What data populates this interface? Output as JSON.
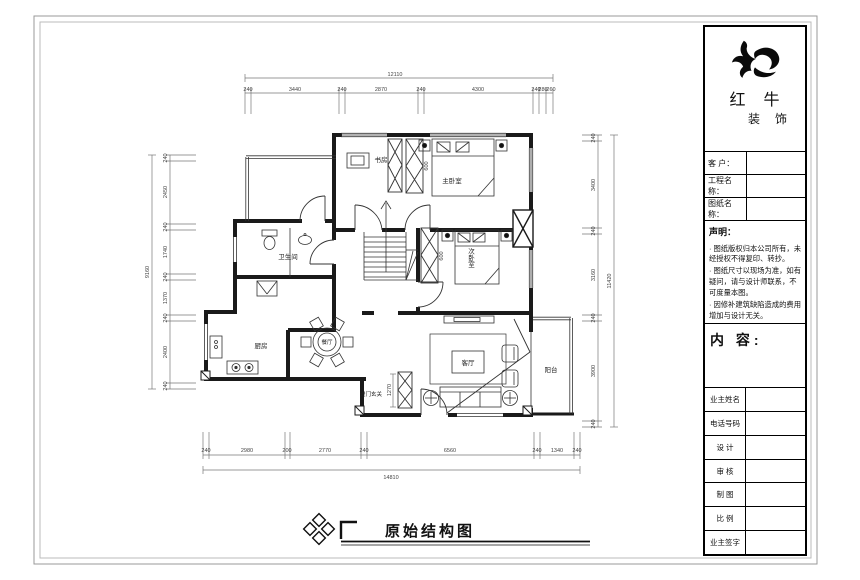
{
  "sheet": {
    "drawing_title": "原始结构图"
  },
  "brand": {
    "name_top": "红 牛",
    "name_bottom": "装 饰"
  },
  "title_block": {
    "fields": [
      {
        "label": "客 户："
      },
      {
        "label": "工程名称："
      },
      {
        "label": "图纸名称："
      }
    ],
    "statement_title": "声明：",
    "statements": [
      "· 图纸版权归本公司所有，未经授权不得复印、转抄。",
      "· 图纸尺寸以现场为准，如有疑问，请与设计师联系，不可度量本图。",
      "· 因修补建筑缺陷造成的费用增加与设计无关。"
    ],
    "content_label": "内 容:",
    "rows": [
      {
        "label": "业主姓名"
      },
      {
        "label": "电话号码"
      },
      {
        "label": "设 计"
      },
      {
        "label": "审 核"
      },
      {
        "label": "制 图"
      },
      {
        "label": "比 例"
      },
      {
        "label": "业主签字"
      }
    ]
  },
  "rooms": {
    "study": "书房",
    "master": "主卧室",
    "second": "次卧室",
    "bath": "卫生间",
    "kitchen": "厨房",
    "dining": "餐厅",
    "living": "客厅",
    "balcony": "阳台",
    "entry": "进门玄关"
  },
  "dims": {
    "top": {
      "total": "12110",
      "segments": [
        "240",
        "3440",
        "240",
        "2870",
        "240",
        "4300",
        "240",
        "280",
        "260"
      ]
    },
    "bottom": {
      "total": "14810",
      "segments": [
        "240",
        "2980",
        "200",
        "2770",
        "240",
        "6560",
        "240",
        "1340",
        "240"
      ]
    },
    "left": {
      "total": "9160",
      "segments": [
        "240",
        "2450",
        "240",
        "1740",
        "240",
        "1370",
        "240",
        "2400",
        "240"
      ]
    },
    "right": {
      "total": "11420",
      "segments": [
        "240",
        "3400",
        "240",
        "3160",
        "240",
        "3900",
        "240"
      ]
    },
    "inner": {
      "entry_cabinet": "1270",
      "wardrobe_master": "600",
      "wardrobe_second": "600"
    }
  }
}
